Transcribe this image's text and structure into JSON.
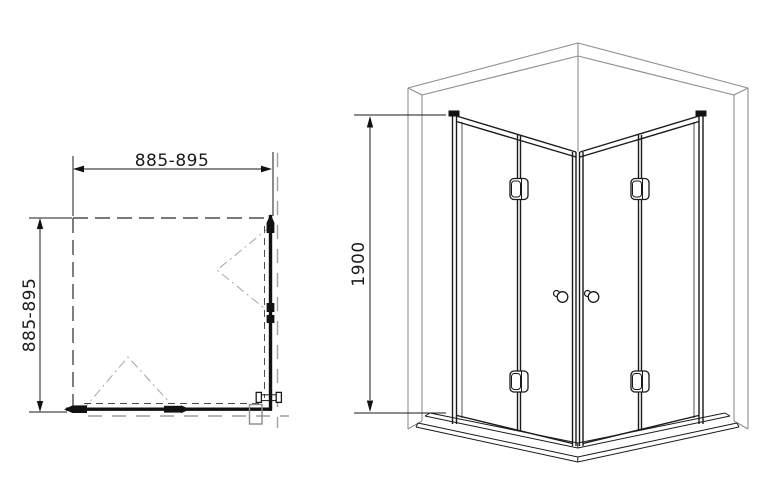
{
  "drawing": {
    "title": "corner shower enclosure technical drawing",
    "plan_view": {
      "width_label": "885-895",
      "depth_label": "885-895"
    },
    "perspective_view": {
      "height_label": "1900"
    },
    "colors": {
      "ink": "#1a1a1a",
      "wall_gray": "#8f8f8f",
      "background": "#ffffff"
    }
  }
}
